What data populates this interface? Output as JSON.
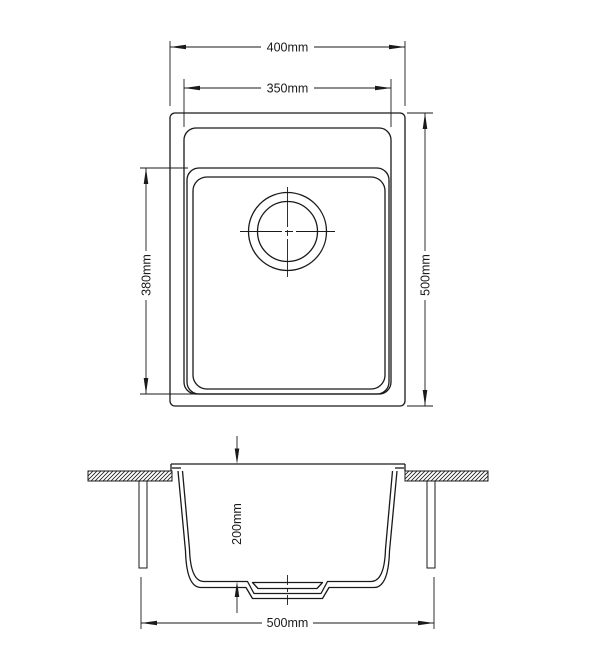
{
  "dims": {
    "plan_outer_width": "400mm",
    "plan_rim_width": "350mm",
    "plan_outer_length": "500mm",
    "plan_bowl_length": "380mm",
    "section_bowl_depth": "200mm",
    "section_base_width": "500mm"
  },
  "colors": {
    "line": "#1a1a1a",
    "background": "#ffffff"
  }
}
